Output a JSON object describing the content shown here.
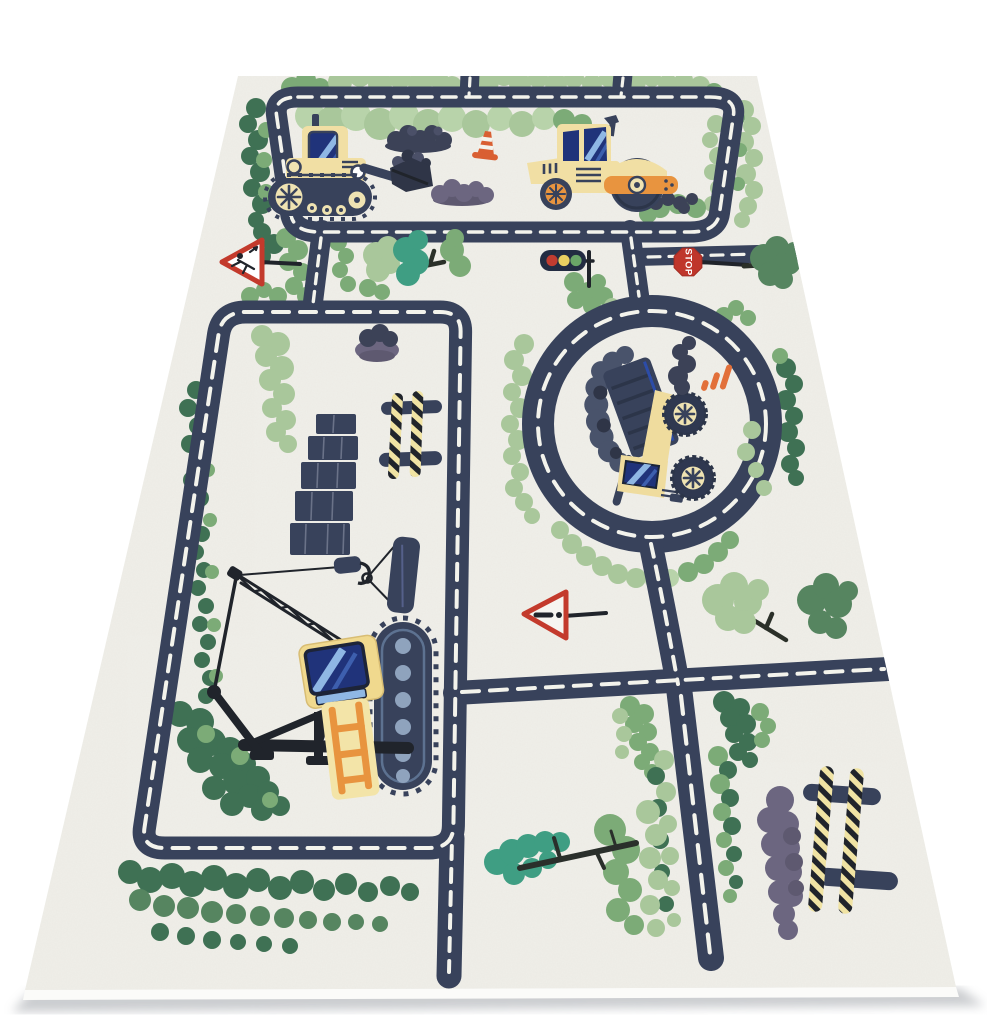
{
  "meta": {
    "description": "Photo of a children's play rug with a road-traffic construction theme, shown in perspective on a white background",
    "scene": "ivory rug printed with navy roads with white dashes, green bushes and trees, construction vehicles, traffic signs"
  },
  "labels": {
    "stop_sign": "STOP"
  },
  "objects": [
    "top-road-loop",
    "left-road-loop",
    "roundabout",
    "crossroad",
    "bulldozer",
    "road-roller",
    "dump-truck",
    "crawler-crane",
    "traffic-cone",
    "traffic-light",
    "stop-sign",
    "warning-sign-children",
    "warning-sign-exclamation",
    "brick-wall",
    "striped-barrier-small",
    "striped-barrier-large",
    "dirt-mounds",
    "gravel-clouds",
    "trees",
    "bushes",
    "fallen-tree"
  ],
  "palette": {
    "page": "#ffffff",
    "rug": "#f0efe9",
    "rug_edge": "#fbfbf9",
    "shadow": "#b9bcc0",
    "road": "#38425b",
    "road_dark": "#2c3549",
    "dash": "#f3f3ec",
    "green_light": "#a9c79b",
    "green_mid": "#7cab77",
    "green_dark": "#568560",
    "green_deep": "#3f7154",
    "green_teal": "#3f9e83",
    "green_bright": "#b8d3aa",
    "vehicle_cream": "#f1dfa4",
    "vehicle_cream2": "#f5e8bb",
    "hub_cream": "#efe3b2",
    "orange": "#e8943f",
    "cone_orange": "#d95f32",
    "sign_red": "#c33a2c",
    "stop_red": "#bf362b",
    "window_blue": "#20337a",
    "window_stripe": "#8fb7e4",
    "window_mid": "#3d5fae",
    "part_black": "#20242b",
    "mound_purple": "#6c6680",
    "mound_purple_dark": "#5e5970",
    "mound_navy": "#3c4257",
    "gravel": "#4b5068",
    "gravel_dark": "#2f3547",
    "gravel_light": "#49536b",
    "barrier_yellow": "#f0e3a3",
    "track_dot": "#8fa3bd",
    "light_red": "#c13c30",
    "light_yellow": "#ead061",
    "light_green": "#6aa567"
  }
}
